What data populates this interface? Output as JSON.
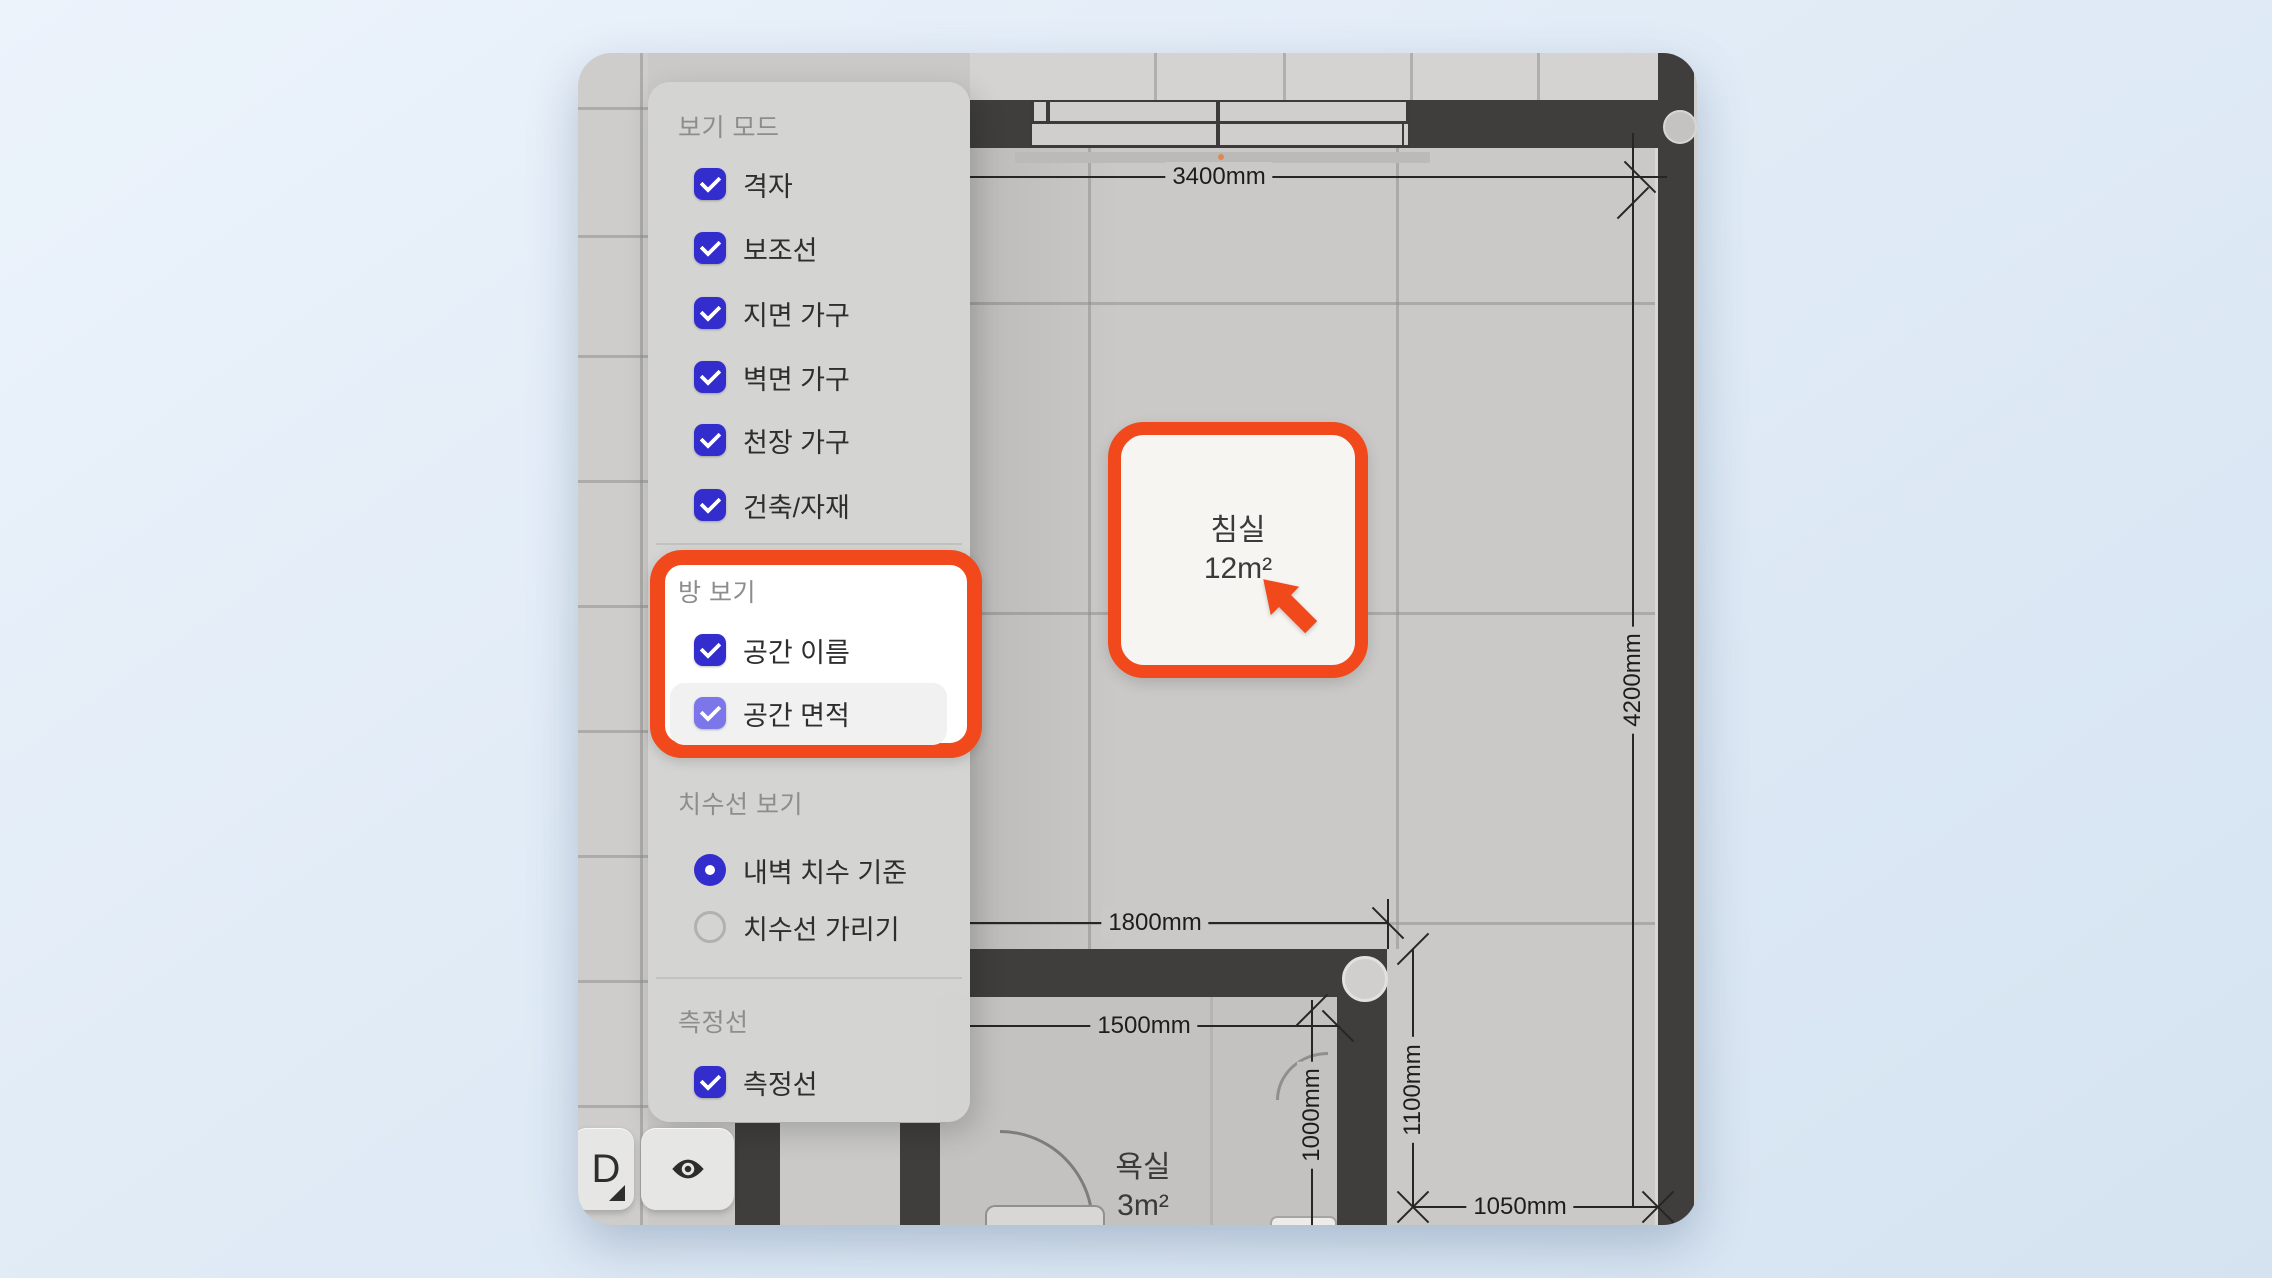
{
  "colors": {
    "accent_blue": "#342dce",
    "accent_blue_light": "#7b76e9",
    "highlight_orange": "#f1481c",
    "wall": "#3f3e3d",
    "panel_bg": "#d4d4d3",
    "dim_line": "#262626"
  },
  "icons": {
    "check": "check-icon",
    "radio_selected": "radio-selected-icon",
    "eye": "eye-icon",
    "dropdown_corner": "corner-triangle-icon",
    "cursor": "cursor-pointer-icon"
  },
  "panel": {
    "view_mode": {
      "title": "보기 모드",
      "items": [
        "격자",
        "보조선",
        "지면 가구",
        "벽면 가구",
        "천장 가구",
        "건축/자재"
      ]
    },
    "room_view": {
      "title": "방 보기",
      "items": [
        "공간 이름",
        "공간 면적"
      ]
    },
    "dimension_view": {
      "title": "치수선 보기",
      "options": [
        "내벽 치수 기준",
        "치수선 가리기"
      ],
      "selected": "내벽 치수 기준"
    },
    "measure": {
      "title": "측정선",
      "items": [
        "측정선"
      ]
    }
  },
  "floorplan": {
    "rooms": [
      {
        "name": "침실",
        "area": "12m²"
      },
      {
        "name": "욕실",
        "area": "3m²"
      }
    ],
    "dimensions": {
      "top_width": "3400mm",
      "right_height": "4200mm",
      "bath_outer_width": "1800mm",
      "bath_inner_width": "1500mm",
      "bath_depth": "1000mm",
      "entry_width": "1100mm",
      "bottom_right_width": "1050mm"
    }
  },
  "toolbar": {
    "view_mode_button": "D"
  }
}
